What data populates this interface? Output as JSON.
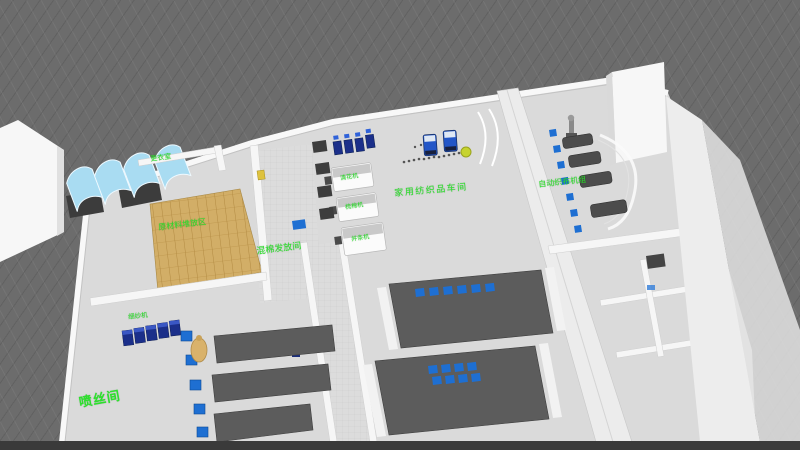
{
  "colors": {
    "background": "#6c6c6c",
    "floor": "#dadada",
    "wall_white": "#f6f6f6",
    "corridor": "#ececec",
    "pallet": "#d2ae67",
    "table_dark": "#5c5c5c",
    "machine_navy": "#1b2f8a",
    "equipment_gray": "#4c4c4c",
    "item_blue": "#1e6fd2",
    "canopy": "#a9dcf2",
    "label_green": "#2be22b",
    "ball_yellow": "#c6d32f",
    "sack_tan": "#d9b26b",
    "dark_band": "#3a3a3a"
  },
  "labels": {
    "spinneret_room": "喷丝间",
    "mixing_room": "混棉发放间",
    "hall": "家用纺织品车间",
    "pallet_area": "原材料堆放区",
    "changing_room": "更衣室",
    "weaving_area": "自动织布机组",
    "spinning_row": "细纱机",
    "machine_1": "清花机",
    "machine_2": "梳棉机",
    "machine_3": "并条机"
  }
}
